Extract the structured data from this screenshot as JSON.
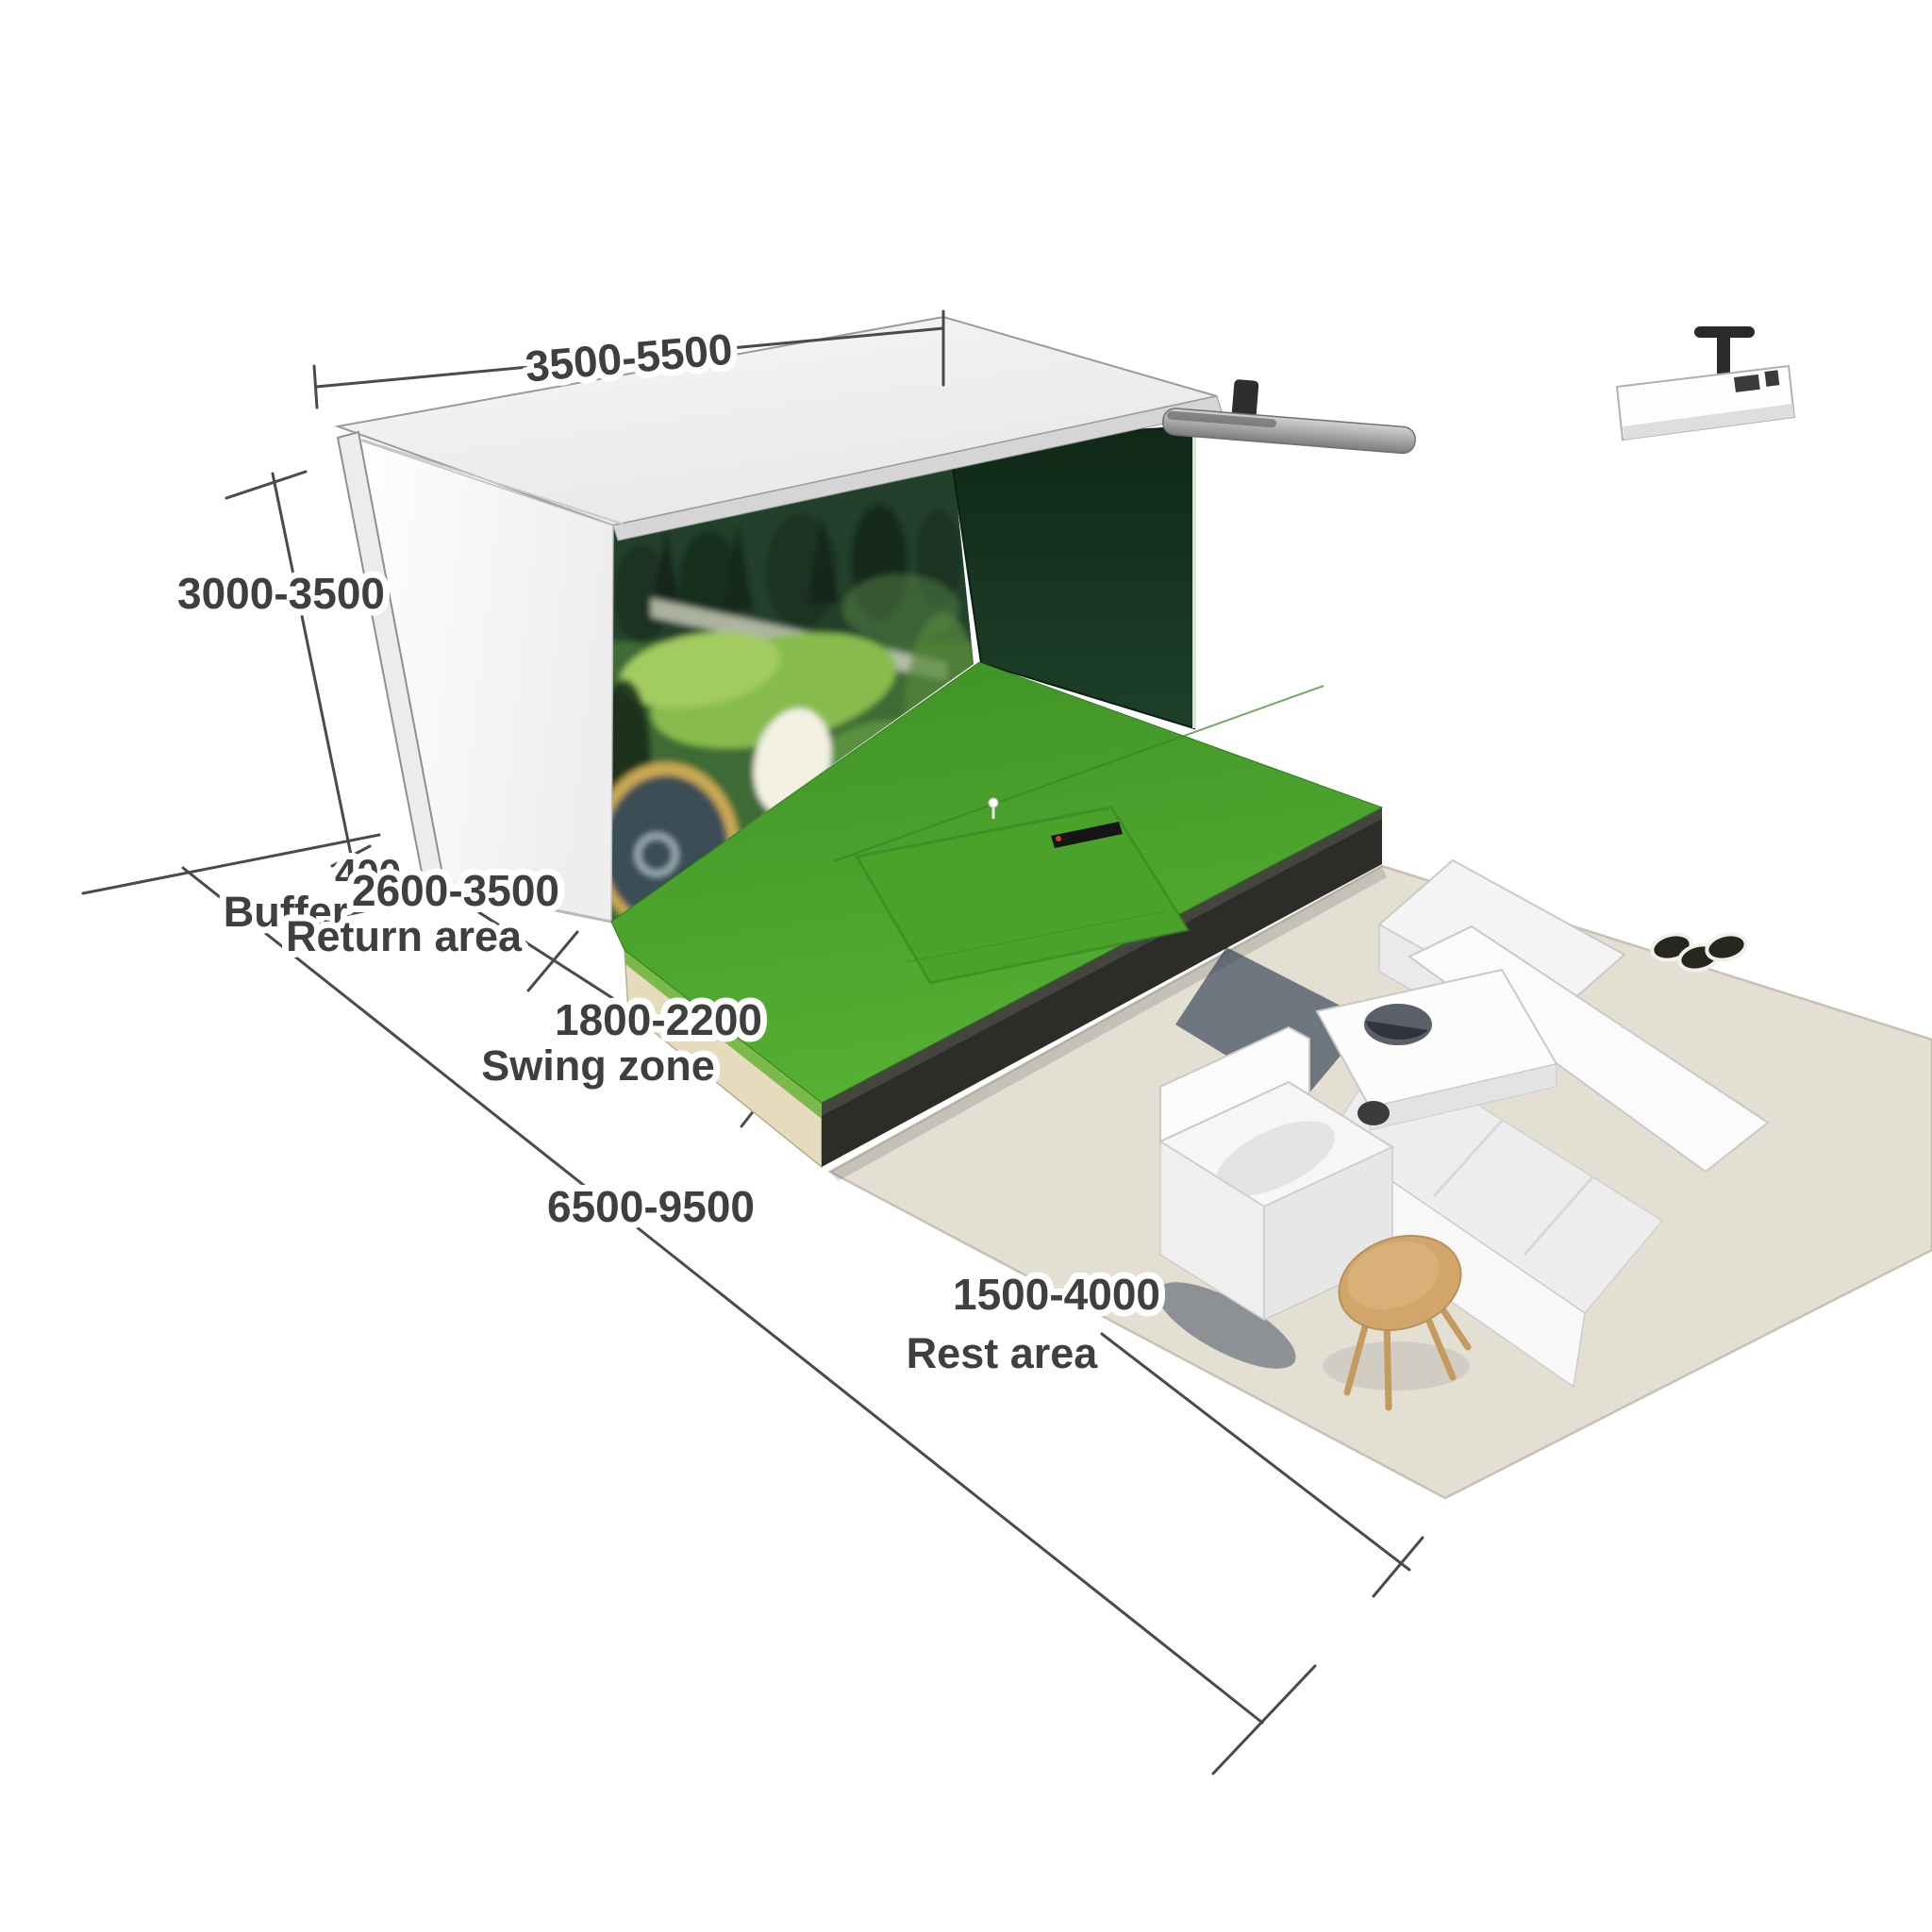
{
  "diagram": {
    "type": "golf-simulator-room-dimension-diagram",
    "background": "#ffffff",
    "dimensions": {
      "enclosure_width": "3500-5500",
      "enclosure_height": "3000-3500",
      "buffer_depth": "400",
      "buffer_label": "Buffer",
      "return_area_depth": "2600-3500",
      "return_area_label": "Return area",
      "swing_zone_depth": "1800-2200",
      "swing_zone_label": "Swing zone",
      "total_depth": "6500-9500",
      "rest_area_depth": "1500-4000",
      "rest_area_label": "Rest area"
    },
    "colors": {
      "turf_green": "#4aa22b",
      "enclosure_side_wall_green": "#16301e",
      "rest_floor_beige": "#e4dfd3",
      "platform_plywood_tan": "#e7dbbd",
      "platform_base_charcoal": "#2c2c28",
      "dimension_line_gray": "#4a4a4a",
      "label_text_gray": "#3f3f3f",
      "sofa_white": "#f6f6f6",
      "stool_tan": "#d2a66b",
      "screen_pond_blue": "#3a4d55"
    },
    "objects": [
      "golf-simulator-enclosure",
      "impact-screen",
      "golf-course-projection",
      "ceiling-panel",
      "left-wall",
      "side-wall",
      "turf-platform",
      "hitting-mat",
      "launch-monitor",
      "golf-tee",
      "screen-roller-bar",
      "ceiling-projector",
      "rest-area-floor",
      "sectional-sofa",
      "armchair",
      "coffee-table",
      "bowl",
      "round-stool",
      "dimension-lines"
    ]
  }
}
